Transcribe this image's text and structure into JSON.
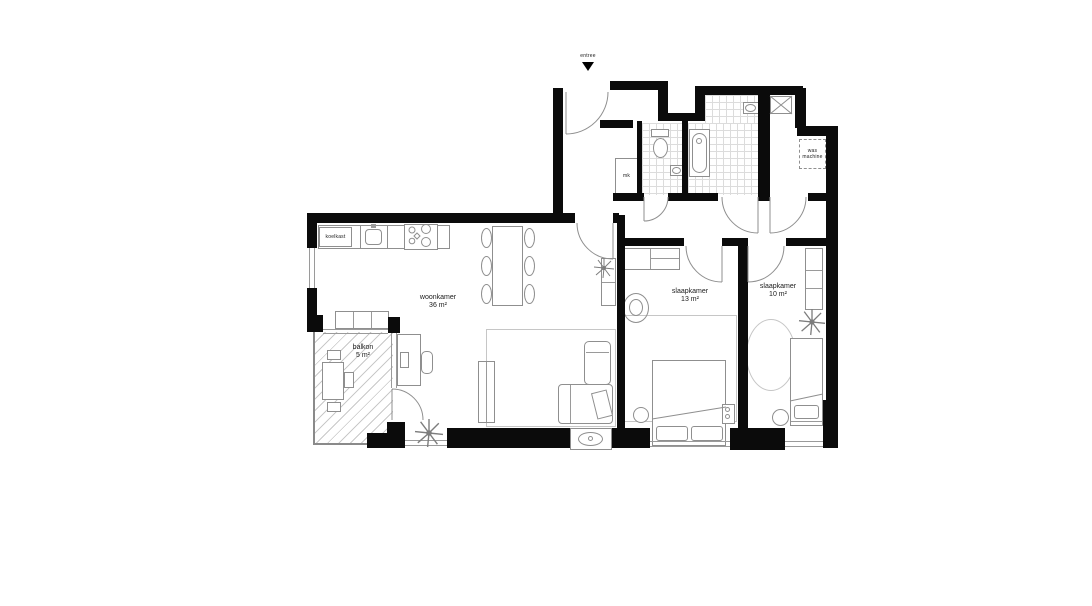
{
  "plan": {
    "entry": {
      "label": "entree"
    },
    "rooms": {
      "living": {
        "name": "woonkamer",
        "area": "36 m²"
      },
      "bedroom_large": {
        "name": "slaapkamer",
        "area": "13 m²"
      },
      "bedroom_small": {
        "name": "slaapkamer",
        "area": "10 m²"
      },
      "balcony": {
        "name": "balkon",
        "area": "5 m²"
      }
    },
    "labels": {
      "meter_cupboard": "mk",
      "fridge": "koelkast",
      "washer_line1": "was",
      "washer_line2": "machine"
    },
    "colors": {
      "wall": "#0b0b0b",
      "furniture_line": "#8f8f8f",
      "tile_line": "#dcdcdc",
      "background": "#ffffff"
    }
  }
}
